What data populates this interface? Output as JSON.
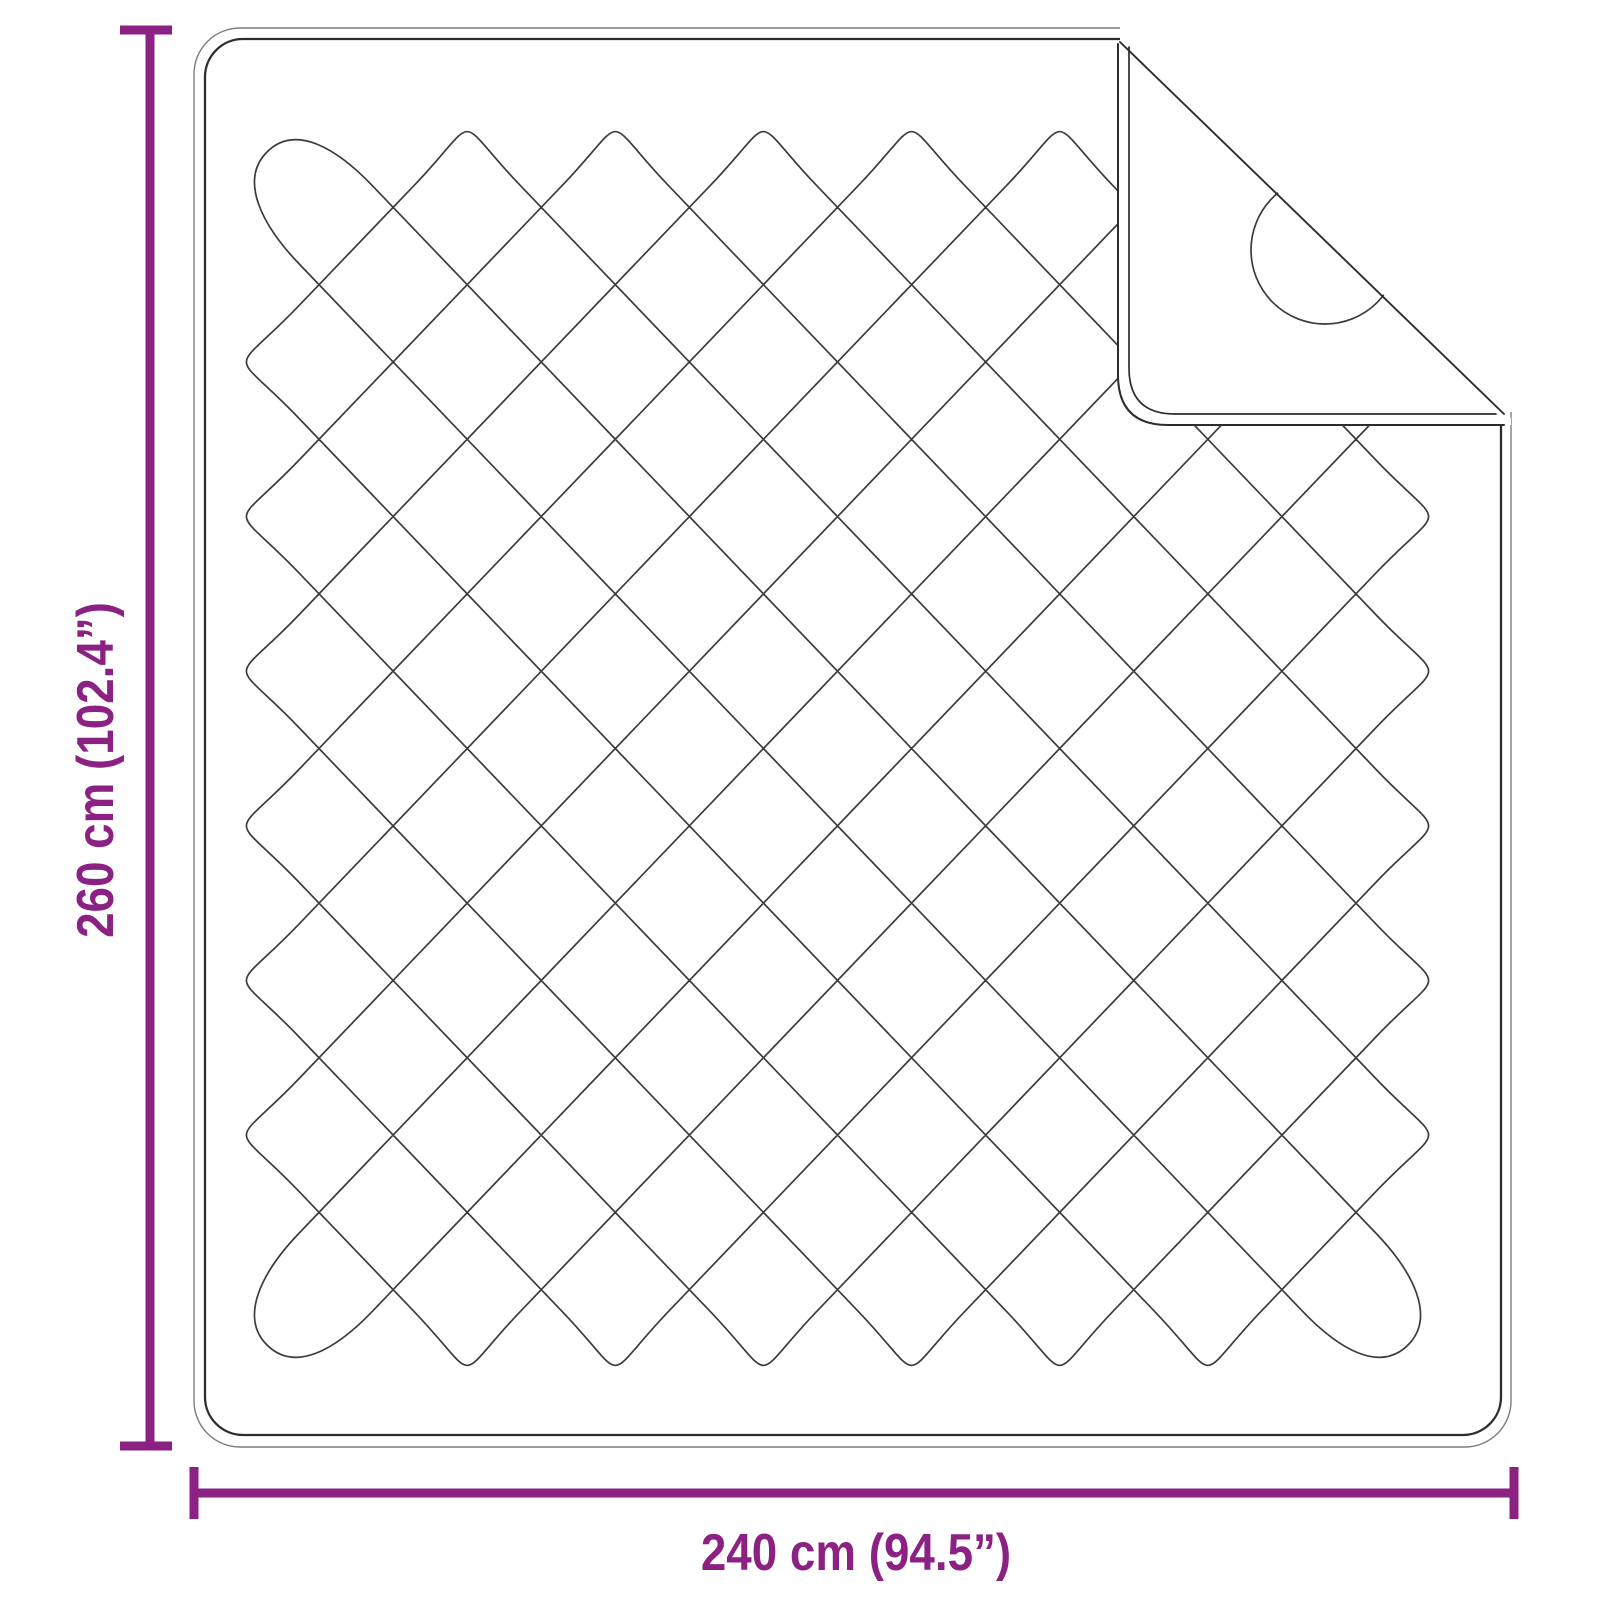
{
  "diagram": {
    "type": "product-dimension-diagram",
    "subject": "quilted blanket with folded corner",
    "dimensions": {
      "height": {
        "label": "260 cm (102.4”)",
        "value_cm": 260,
        "value_inch": 102.4
      },
      "width": {
        "label": "240 cm (94.5”)",
        "value_cm": 240,
        "value_inch": 94.5
      }
    },
    "colors": {
      "accent": "#8B2283",
      "outline_outer": "#7d7d7d",
      "outline_inner": "#2d2d2d",
      "stitch": "#3b3b3b",
      "background": "#ffffff"
    }
  }
}
